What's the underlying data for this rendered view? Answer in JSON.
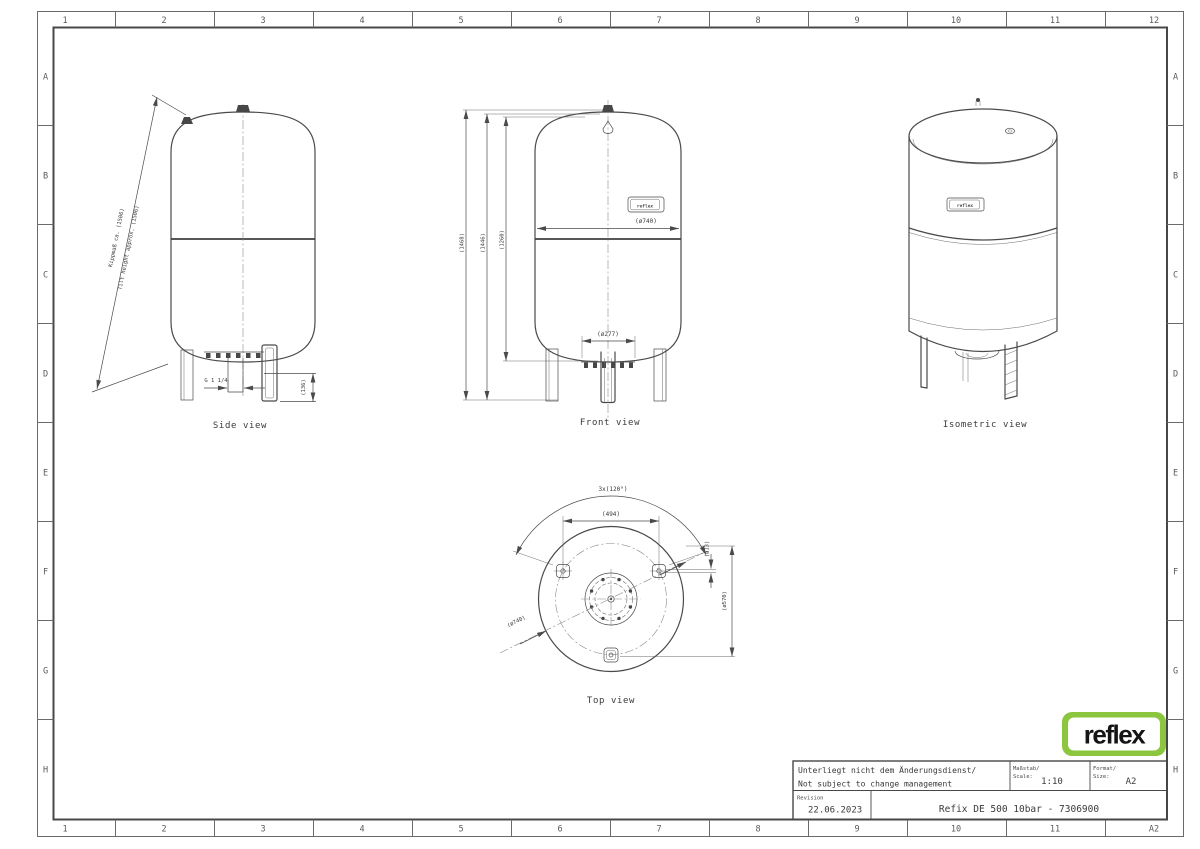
{
  "frame": {
    "columns": [
      "1",
      "2",
      "3",
      "4",
      "5",
      "6",
      "7",
      "8",
      "9",
      "10",
      "11",
      "12"
    ],
    "rows": [
      "A",
      "B",
      "C",
      "D",
      "E",
      "F",
      "G",
      "H"
    ],
    "bottom_right_corner": "A2"
  },
  "logo": {
    "text": "reflex",
    "green": "#8CC63F"
  },
  "title_block": {
    "note_de": "Unterliegt nicht dem Änderungsdienst/",
    "note_en": "Not subject to change management",
    "scale_label_de": "Maßstab/",
    "scale_label_en": "Scale:",
    "scale_value": "1:10",
    "format_label_de": "Format/",
    "format_label_en": "Size:",
    "format_value": "A2",
    "revision_label": "Revision",
    "revision_date": "22.06.2023",
    "document_title": "Refix DE 500 10bar - 7306900"
  },
  "views": {
    "side": {
      "caption": "Side view",
      "dims": {
        "tilt_de": "Kippmaß ca. (1506)",
        "tilt_en": "Tilt height approx. (1506)",
        "connection": "G 1 1/4",
        "leg_height": "(136)"
      }
    },
    "front": {
      "caption": "Front view",
      "nameplate": "reflex",
      "dims": {
        "overall_height": "(1468)",
        "vessel_height": "(1446)",
        "connection_height": "(1260)",
        "diameter": "(ø740)",
        "flange_diameter": "(ø277)"
      }
    },
    "isometric": {
      "caption": "Isometric view",
      "nameplate": "reflex"
    },
    "top": {
      "caption": "Top view",
      "dims": {
        "feet_angle": "3x(120°)",
        "feet_spacing": "(494)",
        "hole_diameter": "(ø13)",
        "feet_circle": "(ø570)",
        "diameter": "(ø740)"
      }
    }
  }
}
